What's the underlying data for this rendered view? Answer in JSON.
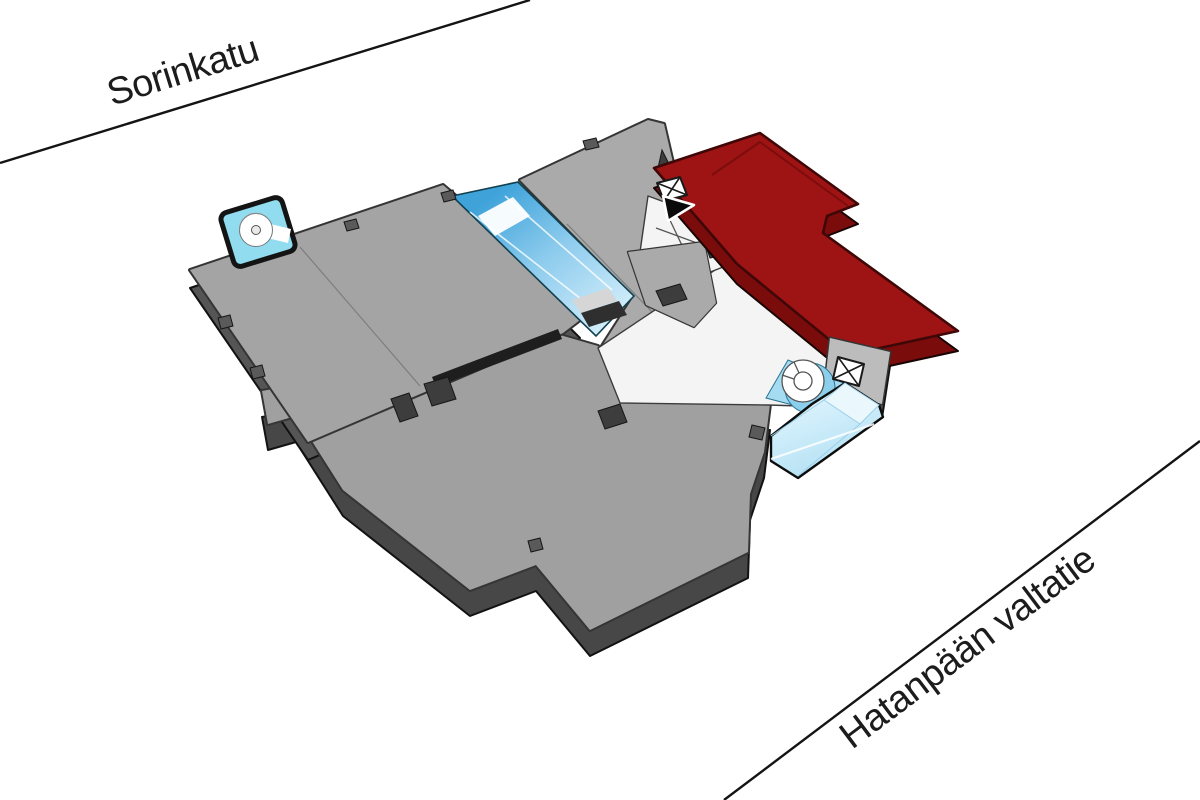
{
  "scene": {
    "type": "3d-floor-plan-location-map",
    "background": "#ffffff",
    "description": "Axonometric building floor plate with one wing highlighted in red, glass atrium elements, and two street reference lines"
  },
  "streets": {
    "top": {
      "label": "Sorinkatu"
    },
    "bottom": {
      "label": "Hatanpään valtatie"
    }
  },
  "building": {
    "highlighted_section": {
      "name": "selected-wing",
      "top_color": "#9e1313",
      "side_color": "#7a0c0c"
    },
    "floor_plates": {
      "top_color": "#a4a4a4",
      "side_color": "#555555",
      "outline_color": "#1f1f1f"
    },
    "corridor": {
      "color": "#f4f4f4"
    },
    "glass": {
      "atrium_strip_color": "#3fa3da",
      "pavilion_box_color": "#cfeefb",
      "small_stair_box_color": "#92dcef"
    },
    "icons": [
      {
        "name": "elevator-icon",
        "location": "upper-core"
      },
      {
        "name": "entrance-arrow-icon",
        "location": "upper-core"
      },
      {
        "name": "spiral-stairs-icon",
        "location": "west-pavilion"
      },
      {
        "name": "round-stairs-icon",
        "location": "east-core"
      },
      {
        "name": "elevator-icon",
        "location": "east-core"
      }
    ]
  }
}
